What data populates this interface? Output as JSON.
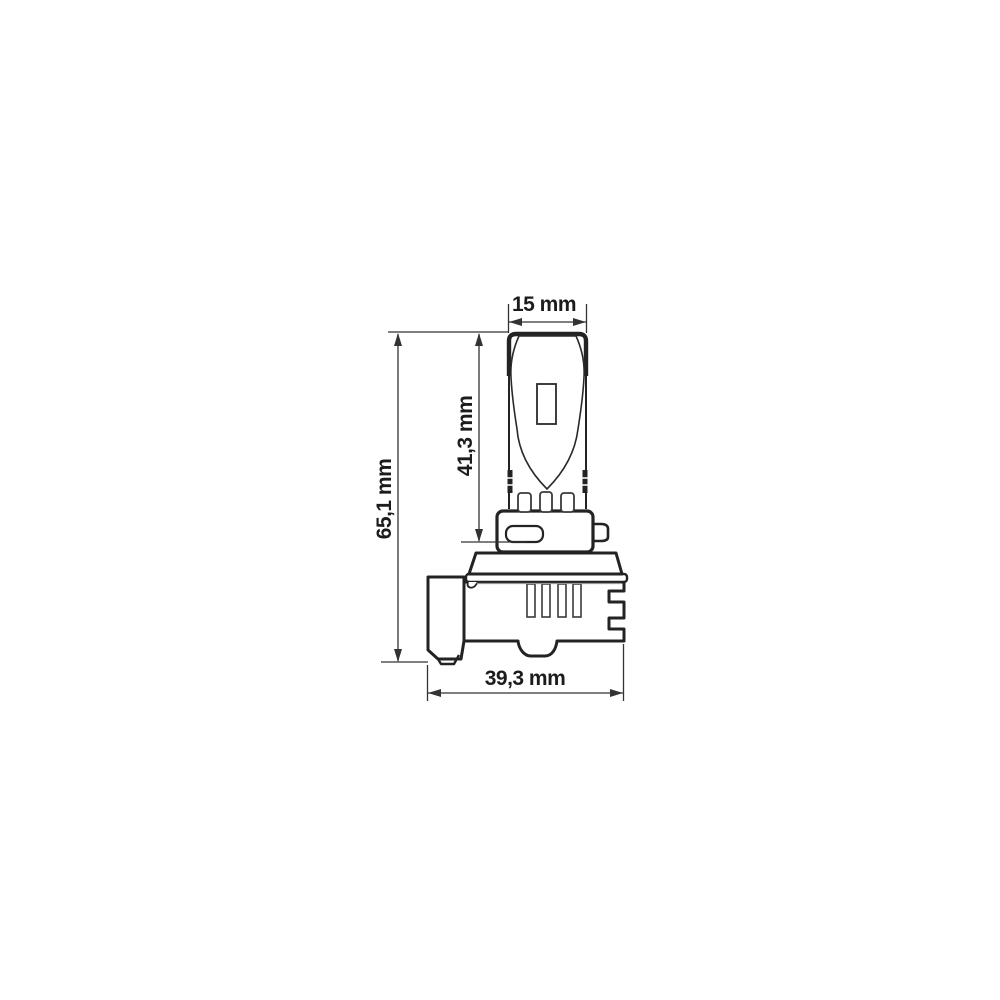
{
  "drawing": {
    "labels": {
      "top_width": "15 mm",
      "upper_height": "41,3 mm",
      "total_height": "65,1 mm",
      "bottom_width": "39,3 mm"
    },
    "values_mm": {
      "top_width": 15,
      "upper_height": 41.3,
      "total_height": 65.1,
      "bottom_width": 39.3
    },
    "colors": {
      "background": "#ffffff",
      "outline": "#232323",
      "thin_line": "#3a3a3a",
      "light_line": "#979797",
      "text": "#1c1c1c"
    }
  }
}
